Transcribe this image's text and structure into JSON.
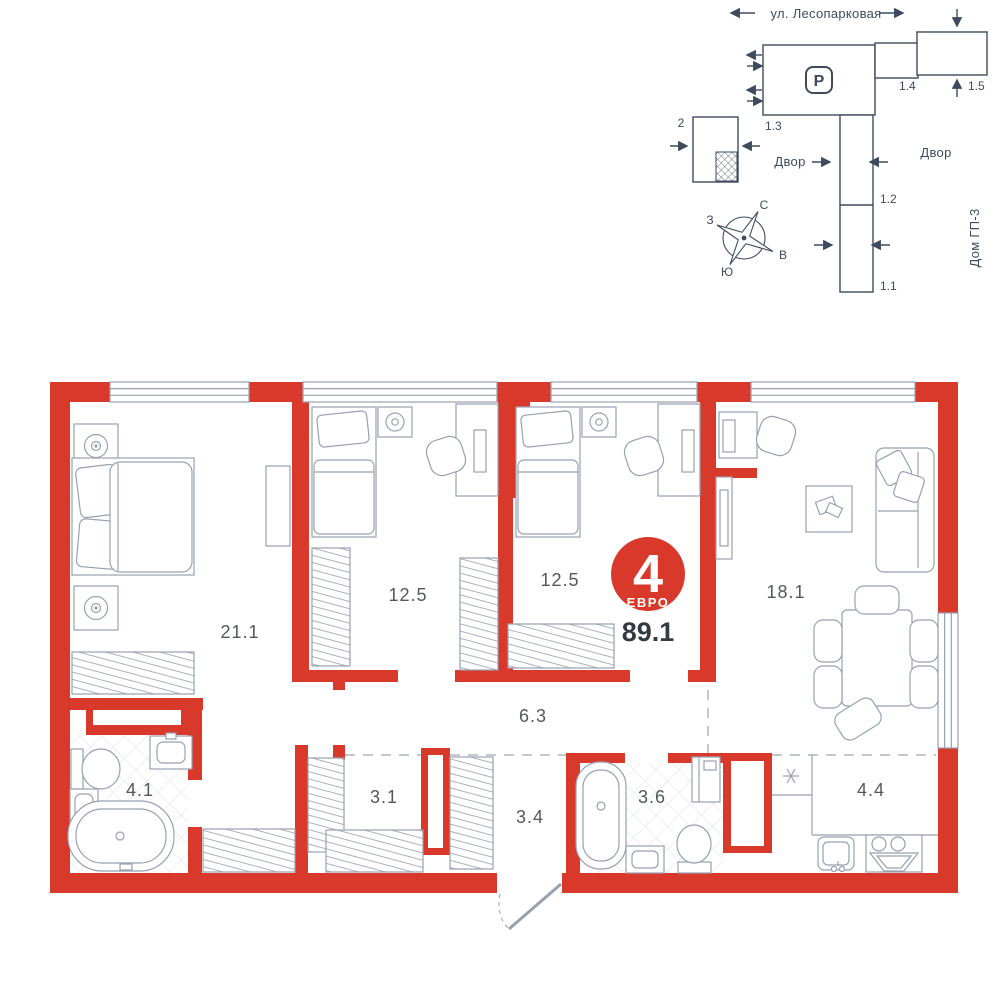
{
  "site_plan": {
    "street_label": "ул. Лесопарковая",
    "parking_label": "P",
    "labels": {
      "building_2": "2",
      "building_1_3": "1.3",
      "building_1_4": "1.4",
      "building_1_5": "1.5",
      "building_1_2": "1.2",
      "building_1_1": "1.1"
    },
    "yard_left": "Двор",
    "yard_right": "Двор",
    "house_label": "Дом ГП-3",
    "compass": {
      "north": "С",
      "east": "В",
      "south": "Ю",
      "west": "З"
    }
  },
  "floor_plan": {
    "badge": {
      "rooms_count": "4",
      "type_label": "ЕВРО",
      "total_area": "89.1"
    },
    "rooms": [
      {
        "name": "bedroom-master",
        "area": "21.1"
      },
      {
        "name": "bedroom-2",
        "area": "12.5"
      },
      {
        "name": "bedroom-3",
        "area": "12.5"
      },
      {
        "name": "living-room",
        "area": "18.1"
      },
      {
        "name": "hallway",
        "area": "6.3"
      },
      {
        "name": "bathroom-main",
        "area": "4.1"
      },
      {
        "name": "wardrobe-room",
        "area": "3.1"
      },
      {
        "name": "entrance-hall",
        "area": "3.4"
      },
      {
        "name": "bathroom-second",
        "area": "3.6"
      },
      {
        "name": "kitchen",
        "area": "4.4"
      }
    ]
  },
  "colors": {
    "accent_red": "#d9392a",
    "plan_line": "#98a1b0",
    "site_line": "#3e4b5e",
    "label_text": "#54575f",
    "dark_text": "#343a42"
  }
}
